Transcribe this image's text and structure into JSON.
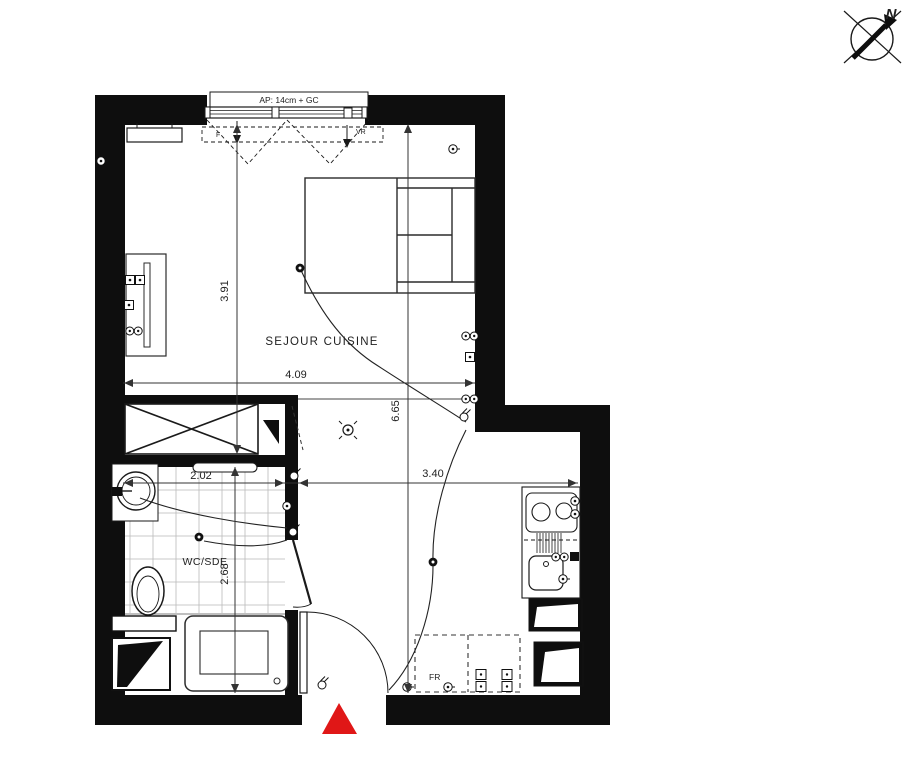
{
  "compass": {
    "label": "N"
  },
  "window": {
    "header": "AP: 14cm + GC",
    "tag_left": "F",
    "tag_right": "VR"
  },
  "rooms": {
    "living": "SEJOUR CUISINE",
    "bathroom": "WC/SDE"
  },
  "appliances": {
    "fridge": "FR"
  },
  "dimensions": {
    "living_height": "3.91",
    "living_width": "4.09",
    "total_height": "6.65",
    "hall_width": "3.40",
    "bathroom_width": "2.02",
    "bathroom_height": "2.68"
  },
  "colors": {
    "wall": "#0e0e0e",
    "line": "#2b2b2b",
    "entry": "#e01717",
    "background": "#ffffff"
  }
}
